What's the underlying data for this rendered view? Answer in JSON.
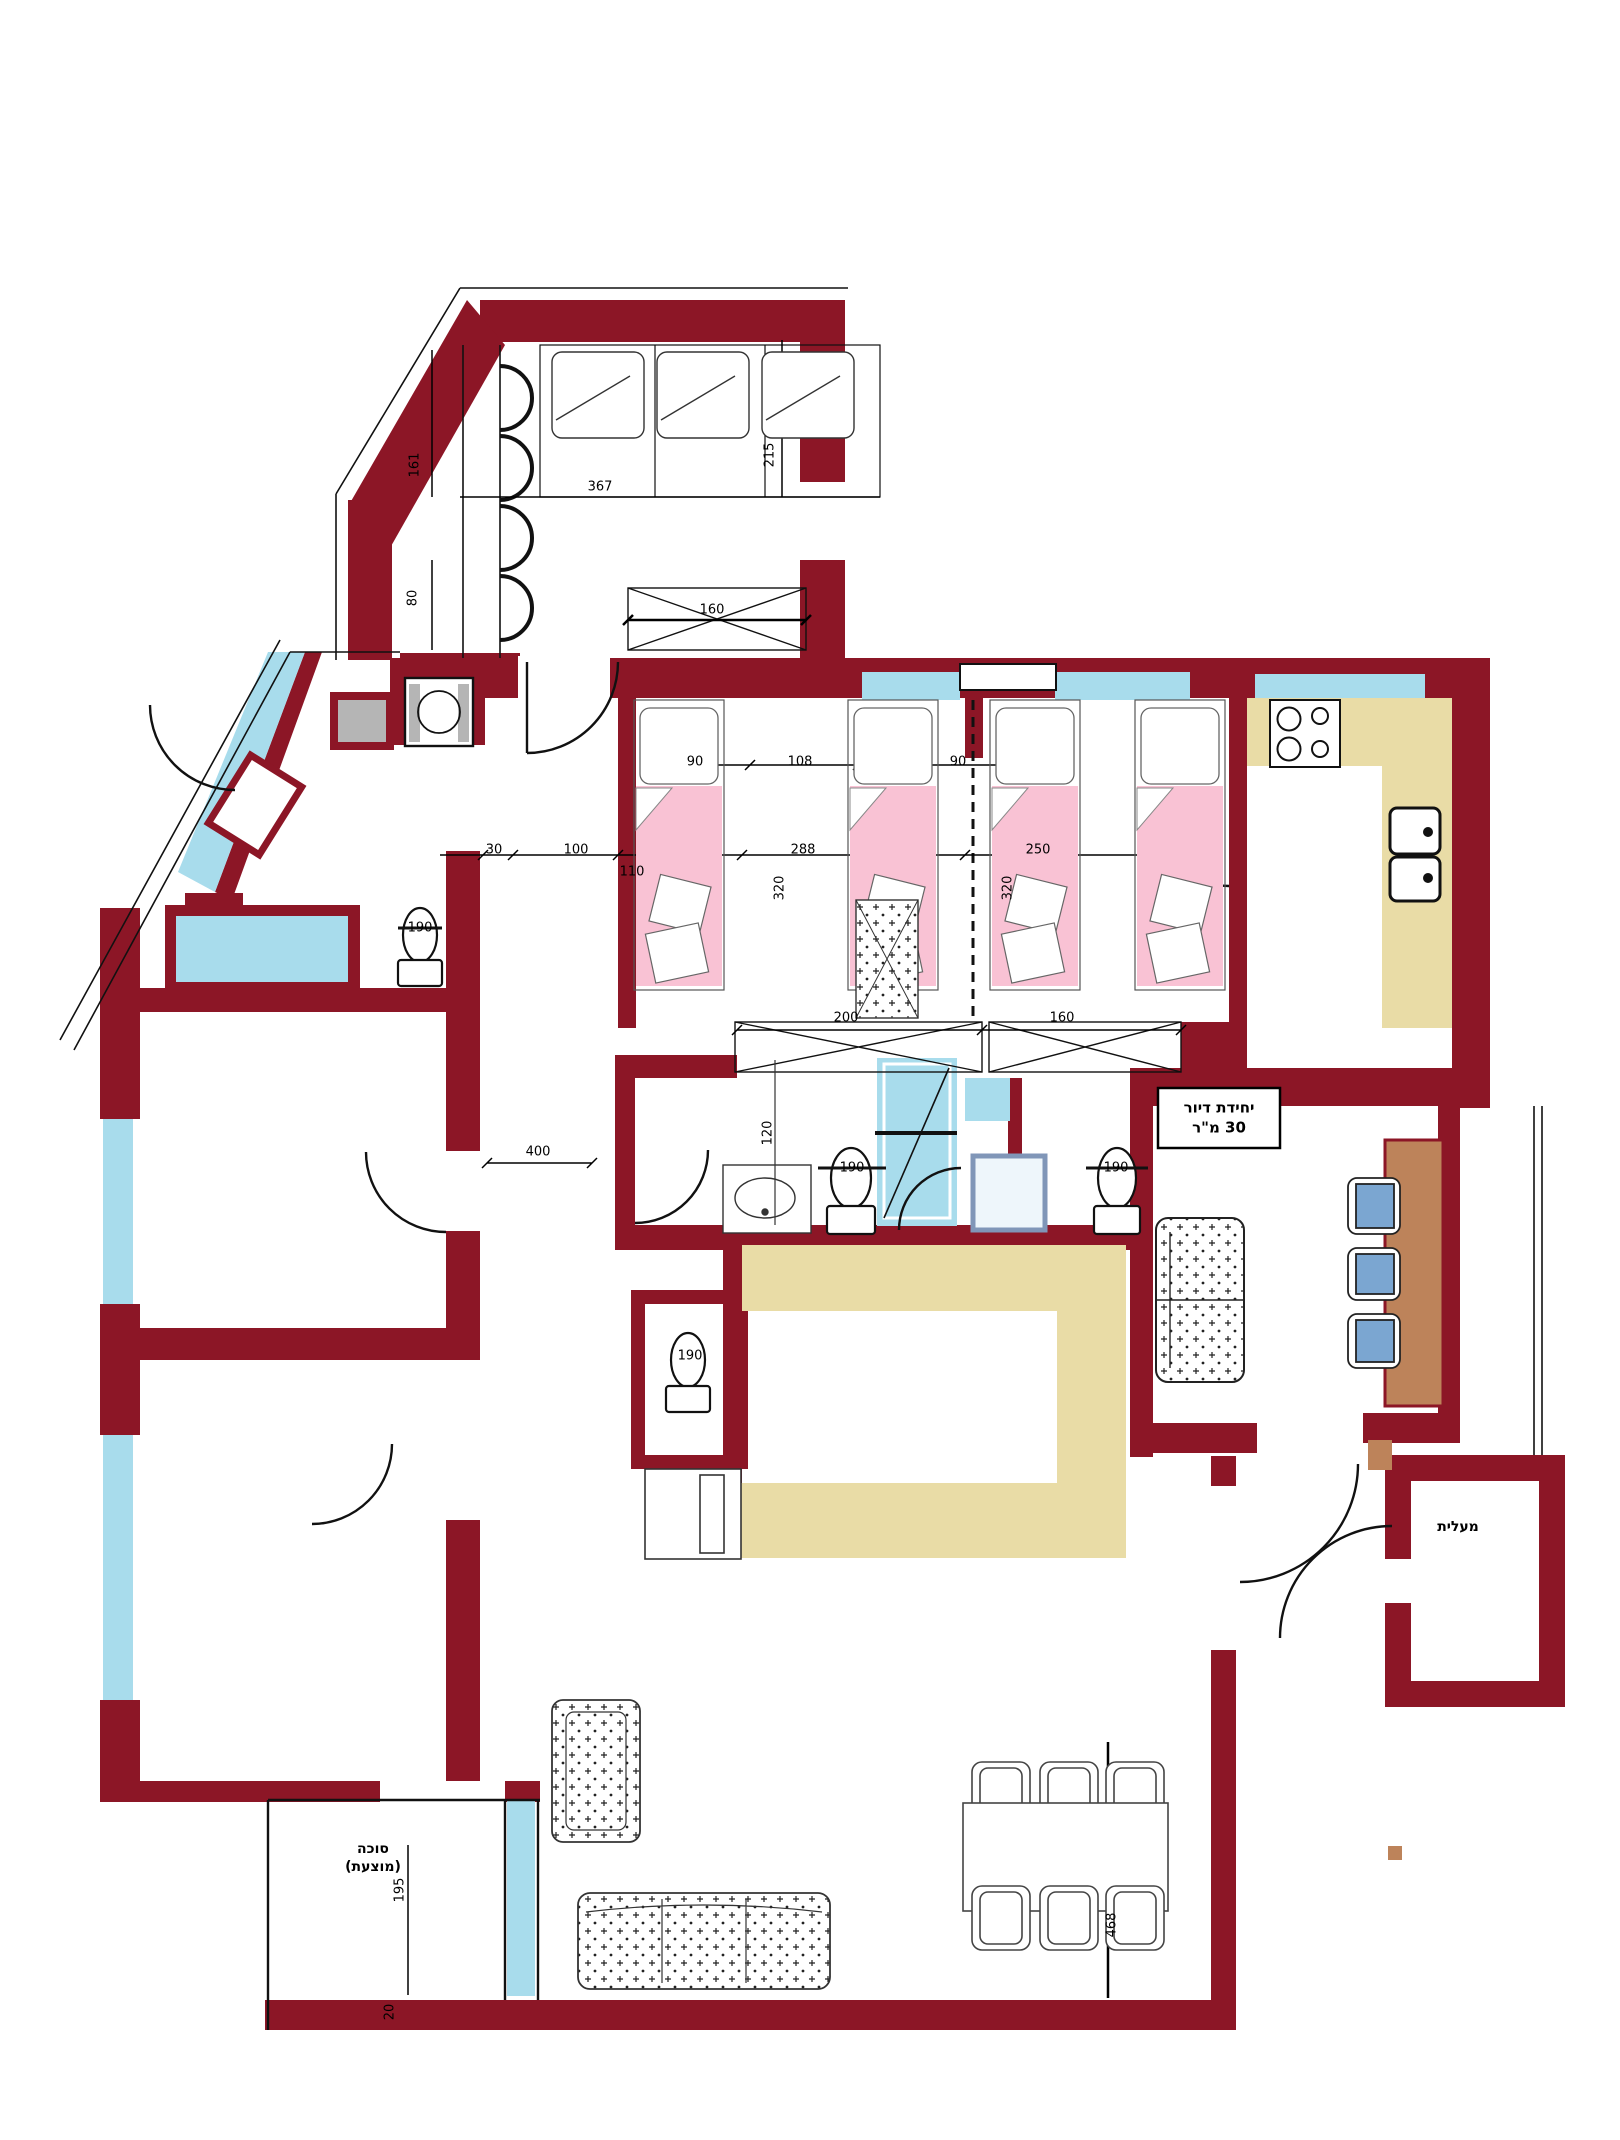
{
  "title": "apartment-floor-plan",
  "colors": {
    "wall": "#8c1626",
    "window_blue": "#a8dcec",
    "bed_pink": "#f9c2d4",
    "counter_tan": "#e9dca6",
    "wood_brown": "#bd835a",
    "chair_blue": "#7ba6d1",
    "shaft_gray": "#b5b5b5",
    "frame_bluegray": "#8096b8"
  },
  "dims": [
    {
      "v": "161"
    },
    {
      "v": "367"
    },
    {
      "v": "215"
    },
    {
      "v": "80"
    },
    {
      "v": "160"
    },
    {
      "v": "90"
    },
    {
      "v": "108"
    },
    {
      "v": "90"
    },
    {
      "v": "30"
    },
    {
      "v": "100"
    },
    {
      "v": "110"
    },
    {
      "v": "288"
    },
    {
      "v": "320"
    },
    {
      "v": "250"
    },
    {
      "v": "320"
    },
    {
      "v": "200"
    },
    {
      "v": "160"
    },
    {
      "v": "190"
    },
    {
      "v": "120"
    },
    {
      "v": "190"
    },
    {
      "v": "190"
    },
    {
      "v": "190"
    },
    {
      "v": "400"
    },
    {
      "v": "195"
    },
    {
      "v": "468"
    },
    {
      "v": "20"
    }
  ],
  "labels": {
    "unit_line1": "יחידת דיור",
    "unit_line2": "30 מ\"ר",
    "elevator": "מעלית",
    "sukkah_line1": "סוכה",
    "sukkah_line2": "(מוצעת)"
  }
}
